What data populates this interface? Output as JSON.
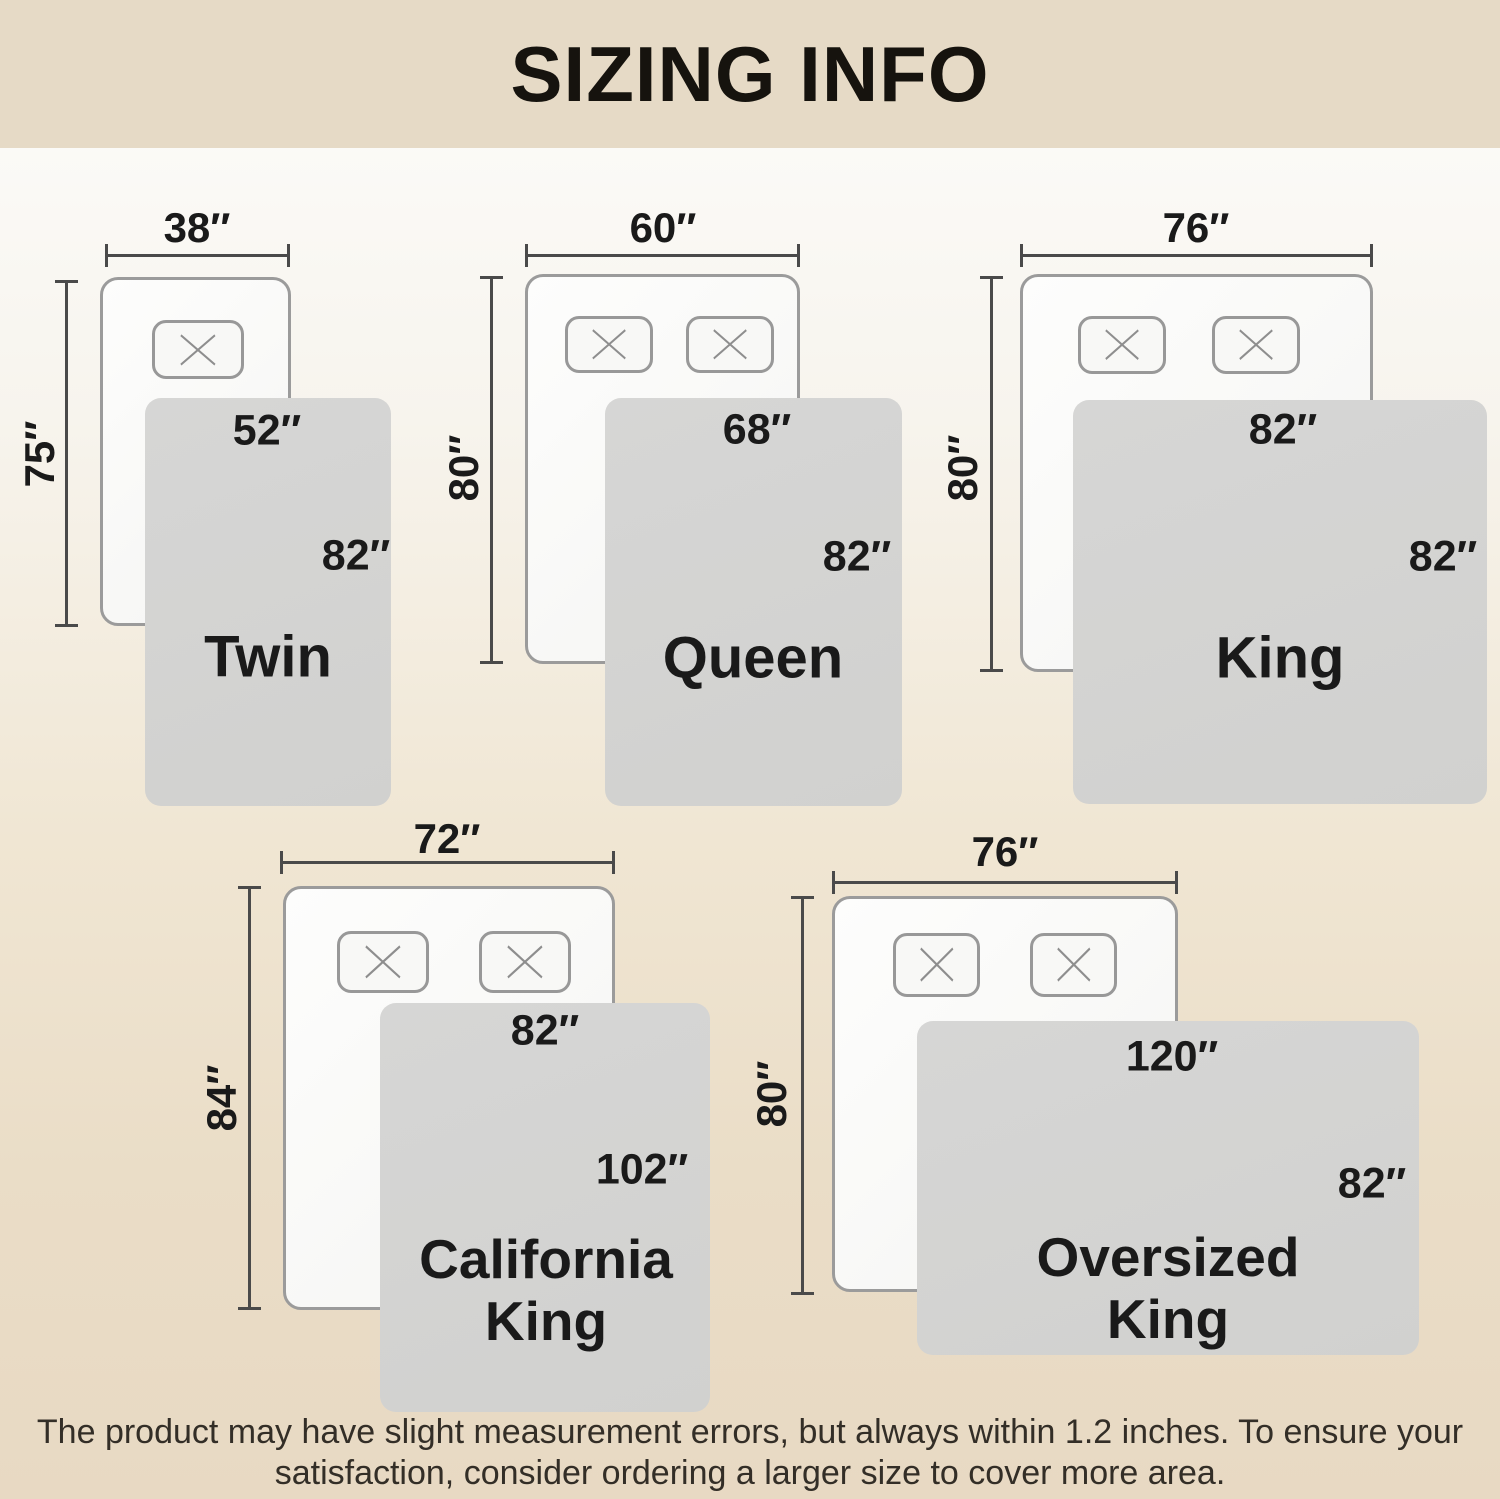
{
  "header": {
    "title": "SIZING INFO"
  },
  "footer": {
    "line1": "The product may have slight measurement errors, but always within 1.2 inches. To ensure your",
    "line2": "satisfaction, consider ordering a larger size to cover more area."
  },
  "colors": {
    "header_bg": "#e6dac6",
    "footer_bg": "#e8d9c3",
    "line": "#4a4a4a",
    "bed_fill": "#f9f9f7",
    "bed_border": "#9b9b9b",
    "blanket_fill": "#d3d3d2",
    "text": "#1a1a1a"
  },
  "sizes": [
    {
      "name_line1": "Twin",
      "name_line2": "",
      "bed_width": "38″",
      "bed_length": "75″",
      "blanket_width": "52″",
      "blanket_length": "82″",
      "pillow_count": 1
    },
    {
      "name_line1": "Queen",
      "name_line2": "",
      "bed_width": "60″",
      "bed_length": "80″",
      "blanket_width": "68″",
      "blanket_length": "82″",
      "pillow_count": 2
    },
    {
      "name_line1": "King",
      "name_line2": "",
      "bed_width": "76″",
      "bed_length": "80″",
      "blanket_width": "82″",
      "blanket_length": "82″",
      "pillow_count": 2
    },
    {
      "name_line1": "California",
      "name_line2": "King",
      "bed_width": "72″",
      "bed_length": "84″",
      "blanket_width": "82″",
      "blanket_length": "102″",
      "pillow_count": 2
    },
    {
      "name_line1": "Oversized",
      "name_line2": "King",
      "bed_width": "76″",
      "bed_length": "80″",
      "blanket_width": "120″",
      "blanket_length": "82″",
      "pillow_count": 2
    }
  ]
}
